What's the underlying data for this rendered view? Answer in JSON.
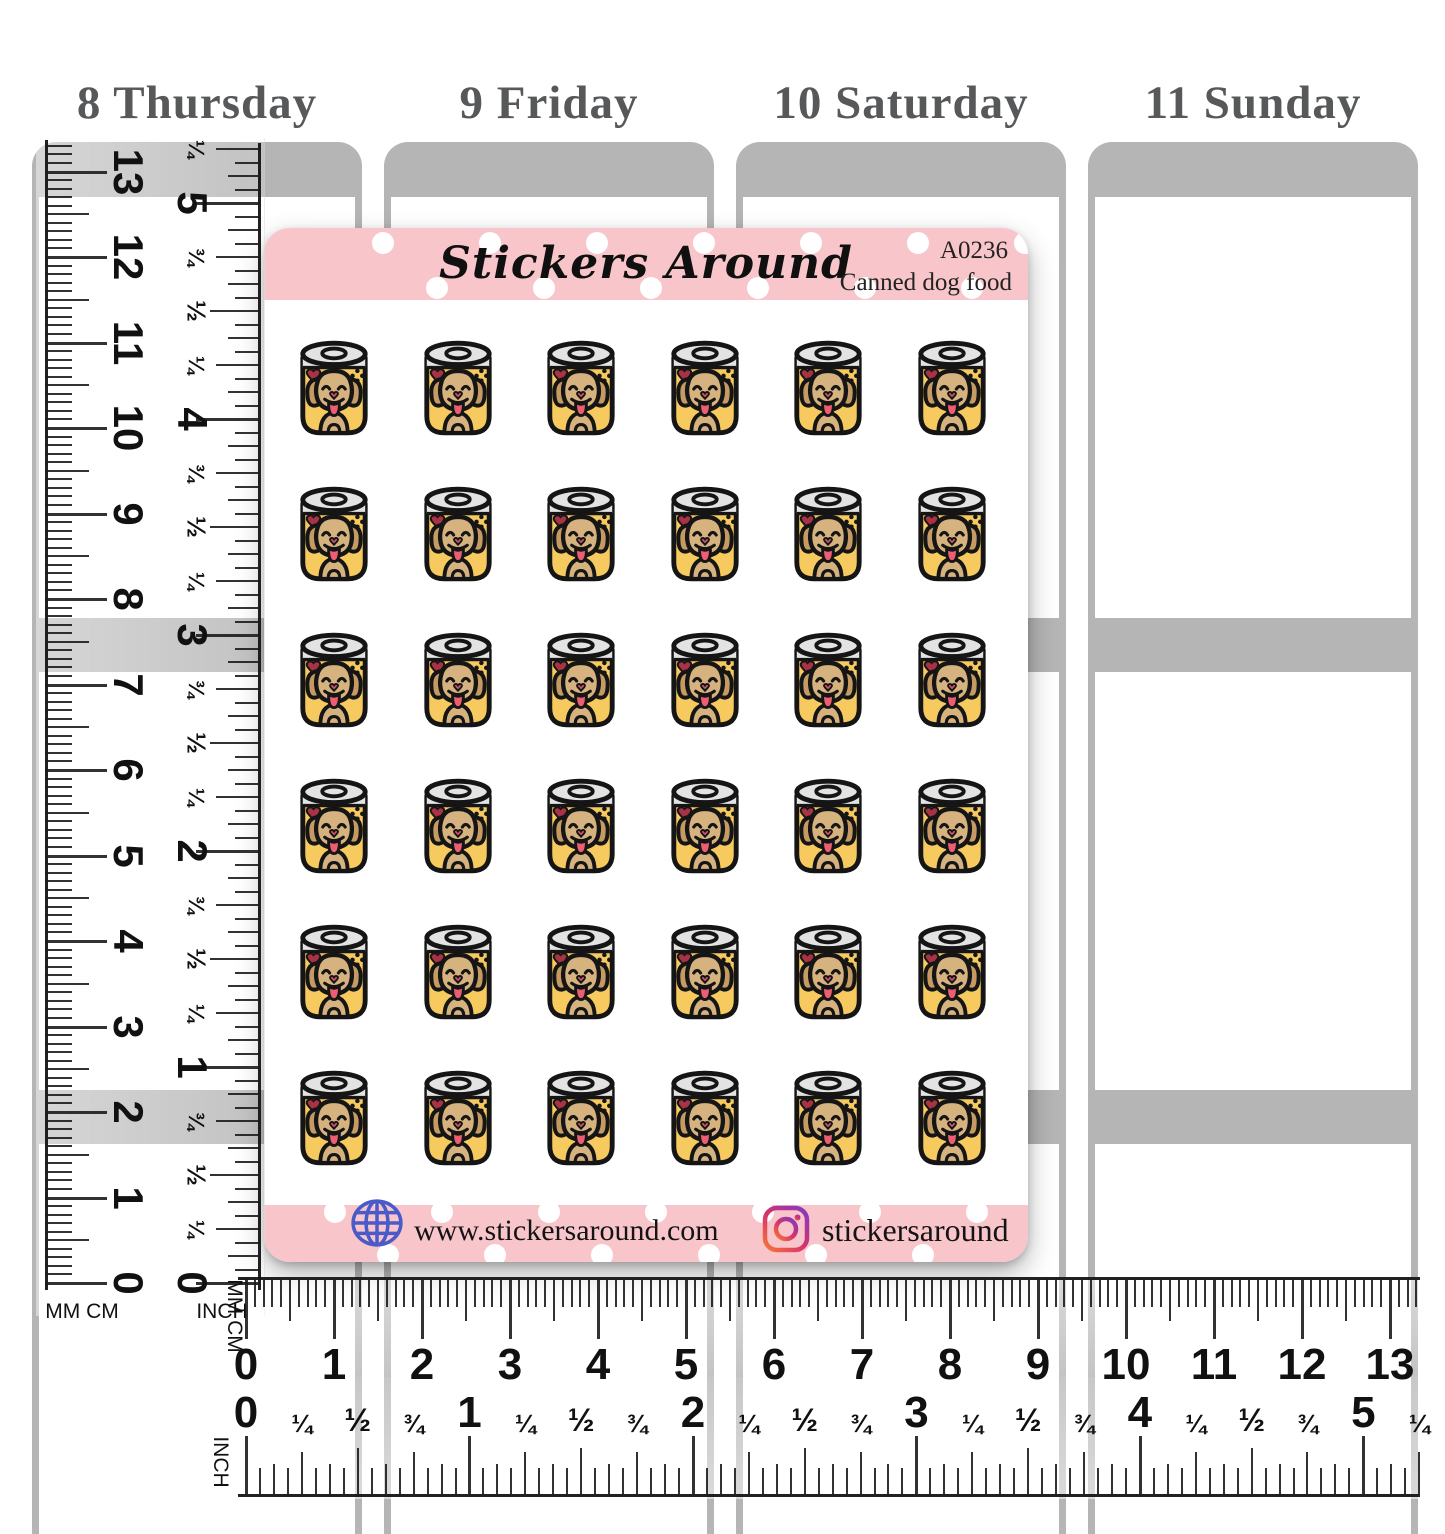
{
  "planner": {
    "days": [
      {
        "label": "8 Thursday"
      },
      {
        "label": "9 Friday"
      },
      {
        "label": "10 Saturday"
      },
      {
        "label": "11 Sunday"
      }
    ]
  },
  "sticker_sheet": {
    "brand": "Stickers Around",
    "sku": "A0236",
    "product_name": "Canned dog food",
    "grid": {
      "rows": 6,
      "cols": 6,
      "count": 36,
      "sticker_name": "canned-dog-food"
    },
    "footer": {
      "website": "www.stickersaround.com",
      "instagram_handle": "stickersaround"
    },
    "colors": {
      "sheet_pink": "#f8c6ca",
      "can_yellow": "#f7ca60",
      "can_lid": "#e3e3e3",
      "dog_tan": "#c69b63",
      "dog_face": "#d6b27f",
      "tongue": "#ee5e72",
      "heart_red": "#a93244",
      "globe_blue": "#4a5ac8",
      "planner_gray": "#b5b5b5"
    }
  },
  "rulers": {
    "vertical_cm": {
      "unit_label": "MM CM",
      "numbers": [
        "0",
        "1",
        "2",
        "3",
        "4",
        "5",
        "6",
        "7",
        "8",
        "9",
        "10",
        "11",
        "12",
        "13"
      ]
    },
    "vertical_inch": {
      "unit_label": "INCH",
      "integer_labels": [
        "0",
        "1",
        "2",
        "3",
        "4",
        "5"
      ],
      "fraction_labels": [
        "¼",
        "½",
        "¾"
      ]
    },
    "horizontal_cm": {
      "unit_label": "MM CM",
      "numbers": [
        "0",
        "1",
        "2",
        "3",
        "4",
        "5",
        "6",
        "7",
        "8",
        "9",
        "10",
        "11",
        "12",
        "13"
      ]
    },
    "horizontal_inch": {
      "unit_label": "INCH",
      "integer_labels": [
        "0",
        "1",
        "2",
        "3",
        "4",
        "5"
      ],
      "fraction_labels": [
        "¼",
        "½",
        "¾"
      ]
    }
  }
}
